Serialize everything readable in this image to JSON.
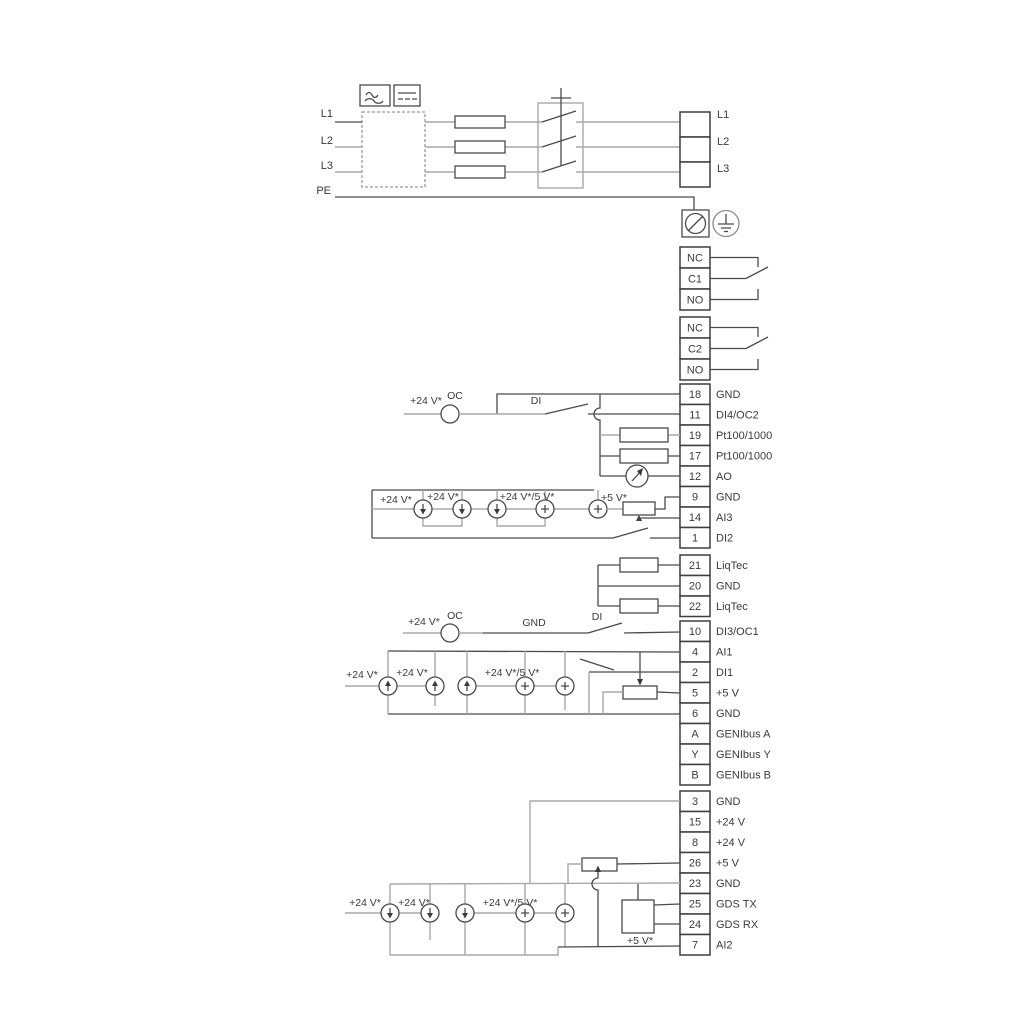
{
  "title": "pump-drive-wiring-diagram",
  "colors": {
    "line_dark": "#4a4a4a",
    "line_gray": "#a9a9a9",
    "text": "#3a3a3a",
    "background": "#ffffff"
  },
  "power": {
    "inputs": [
      {
        "label": "L1"
      },
      {
        "label": "L2"
      },
      {
        "label": "L3"
      },
      {
        "label": "PE"
      }
    ],
    "outputs": [
      {
        "label": "L1"
      },
      {
        "label": "L2"
      },
      {
        "label": "L3"
      }
    ]
  },
  "relays": {
    "relay1": [
      {
        "label": "NC"
      },
      {
        "label": "C1"
      },
      {
        "label": "NO"
      }
    ],
    "relay2": [
      {
        "label": "NC"
      },
      {
        "label": "C2"
      },
      {
        "label": "NO"
      }
    ]
  },
  "terminals": {
    "groupA": [
      {
        "num": "18",
        "label": "GND"
      },
      {
        "num": "11",
        "label": "DI4/OC2"
      },
      {
        "num": "19",
        "label": "Pt100/1000"
      },
      {
        "num": "17",
        "label": "Pt100/1000"
      },
      {
        "num": "12",
        "label": "AO"
      },
      {
        "num": "9",
        "label": "GND"
      },
      {
        "num": "14",
        "label": "AI3"
      },
      {
        "num": "1",
        "label": "DI2"
      }
    ],
    "groupB": [
      {
        "num": "21",
        "label": "LiqTec"
      },
      {
        "num": "20",
        "label": "GND"
      },
      {
        "num": "22",
        "label": "LiqTec"
      }
    ],
    "groupC": [
      {
        "num": "10",
        "label": "DI3/OC1"
      },
      {
        "num": "4",
        "label": "AI1"
      },
      {
        "num": "2",
        "label": "DI1"
      },
      {
        "num": "5",
        "label": "+5 V"
      },
      {
        "num": "6",
        "label": "GND"
      },
      {
        "num": "A",
        "label": "GENIbus A"
      },
      {
        "num": "Y",
        "label": "GENIbus Y"
      },
      {
        "num": "B",
        "label": "GENIbus B"
      }
    ],
    "groupD": [
      {
        "num": "3",
        "label": "GND"
      },
      {
        "num": "15",
        "label": "+24 V"
      },
      {
        "num": "8",
        "label": "+24 V"
      },
      {
        "num": "26",
        "label": "+5 V"
      },
      {
        "num": "23",
        "label": "GND"
      },
      {
        "num": "25",
        "label": "GDS TX"
      },
      {
        "num": "24",
        "label": "GDS RX"
      },
      {
        "num": "7",
        "label": "AI2"
      }
    ]
  },
  "annotations": {
    "v24": "+24 V*",
    "v245": "+24 V*/5 V*",
    "v5": "+5 V*",
    "oc": "OC",
    "di": "DI",
    "gnd": "GND"
  }
}
